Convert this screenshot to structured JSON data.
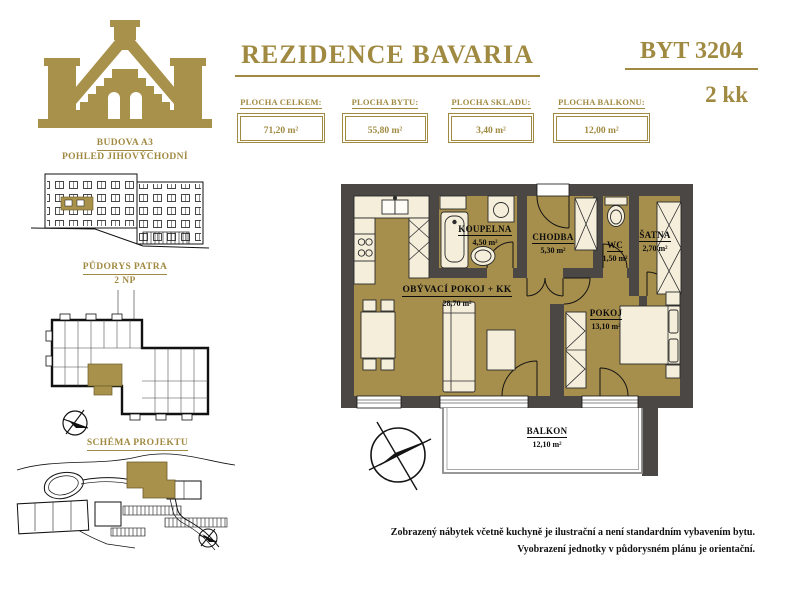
{
  "header": {
    "title": "REZIDENCE BAVARIA",
    "unit_number": "BYT 3204",
    "unit_type": "2 kk",
    "stats": [
      {
        "label": "PLOCHA CELKEM:",
        "value": "71,20 m²"
      },
      {
        "label": "PLOCHA BYTU:",
        "value": "55,80 m²"
      },
      {
        "label": "PLOCHA SKLADU:",
        "value": "3,40 m²"
      },
      {
        "label": "PLOCHA BALKONU:",
        "value": "12,00 m²"
      }
    ]
  },
  "sidebar": {
    "building_label": "BUDOVA A3",
    "view_label": "POHLED JIHOVÝCHODNÍ",
    "floorplan_label": "PŮDORYS PATRA",
    "floor_number": "2 NP",
    "schema_label": "SCHÉMA PROJEKTU"
  },
  "floorplan": {
    "rooms": [
      {
        "name": "KOUPELNA",
        "area": "4,50 m²"
      },
      {
        "name": "CHODBA",
        "area": "5,30 m²"
      },
      {
        "name": "WC",
        "area": "1,50 m²"
      },
      {
        "name": "ŠATNA",
        "area": "2,70 m²"
      },
      {
        "name": "OBÝVACÍ POKOJ + KK",
        "area": "28,70 m²"
      },
      {
        "name": "POKOJ",
        "area": "13,10 m²"
      },
      {
        "name": "BALKON",
        "area": "12,10 m²"
      }
    ]
  },
  "footer": {
    "line1": "Zobrazený nábytek včetně kuchyně je ilustrační a není standardním vybavením bytu.",
    "line2": "Vyobrazení jednotky v půdorysném plánu je orientační."
  },
  "colors": {
    "gold_accent": "#a08a42",
    "floor_gold": "#a68e4c",
    "wall_dark": "#4b4744",
    "furniture_cream": "#f4eedb"
  }
}
